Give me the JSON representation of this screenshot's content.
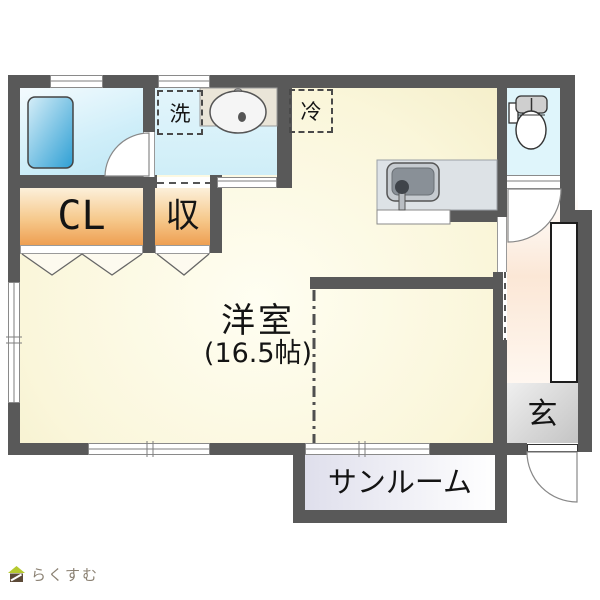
{
  "title": "floor-plan",
  "rooms": {
    "main": {
      "label": "洋室",
      "size": "(16.5帖)"
    },
    "sunroom": {
      "label": "サンルーム"
    },
    "entrance": {
      "label": "玄"
    },
    "closet": {
      "label": "CL"
    },
    "storage": {
      "label": "収"
    },
    "washer_space": {
      "label": "洗"
    },
    "fridge_space": {
      "label": "冷"
    }
  },
  "fixtures": [
    "bathtub",
    "washbasin",
    "kitchen-sink",
    "toilet",
    "shoe-cabinet"
  ],
  "branding": {
    "logo_text": "らくすむ"
  },
  "colors": {
    "wall": "#595959",
    "main_room": "#fbf8dd",
    "bathroom": "#d2edf8",
    "washroom": "#d9f1f9",
    "toilet": "#dff5fb",
    "closet_top": "#fcf0da",
    "closet_bottom": "#ee9f52",
    "corridor": "#fbe7d6",
    "entrance": "#cccccc",
    "sunroom": "#e0e0ed",
    "bathtub": "#2fa7dc",
    "counter": "#dde2e6",
    "basin_counter": "#eae5d8",
    "logo_green": "#b5c92e",
    "logo_brown": "#5c4a38",
    "logo_text_color": "#8b8173"
  }
}
